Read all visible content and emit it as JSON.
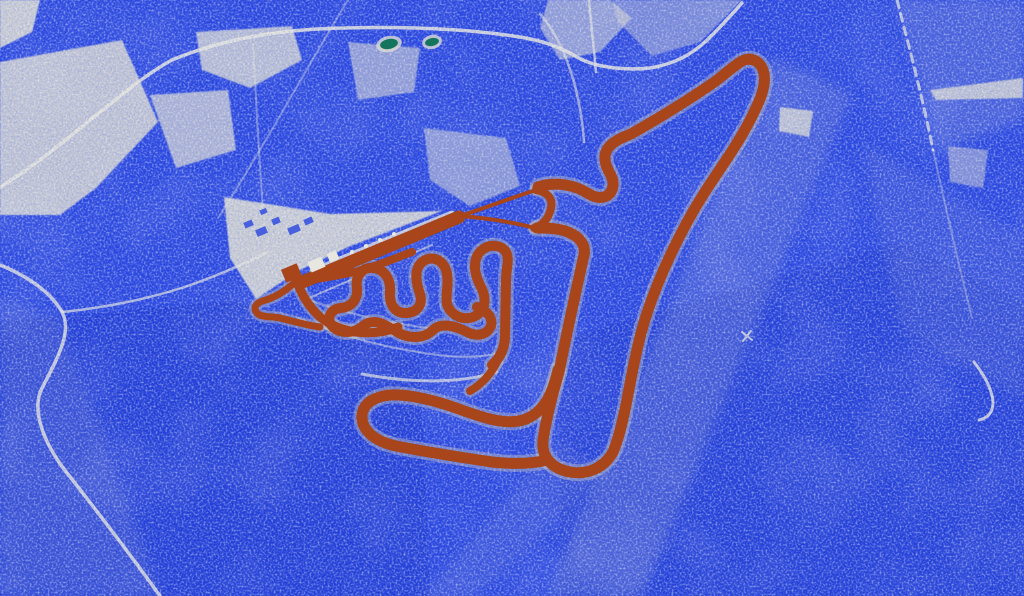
{
  "meta": {
    "description": "Stylized blue-dithered aerial satellite view of a race circuit, track highlighted in rust orange",
    "type": "aerial-map"
  },
  "colors": {
    "base_blue": "#2845df",
    "deep_blue": "#1c37d0",
    "field_white": "#d9d8d0",
    "road_white": "#e6e5dd",
    "track_rust": "#a8451a",
    "track_edge_gray": "#c9c8c0",
    "pond_teal": "#15745e",
    "pond_halo": "#dcdbd3",
    "building_white": "#e8e7df",
    "building_blue": "#2845df"
  },
  "map": {
    "darks": {
      "d1": "M 0,322 L 238,300 L 420,362 L 430,596 L 0,596 Z",
      "d2": "M 560,340 L 900,242 L 1024,302 L 1024,596 L 560,596 Z"
    },
    "bands": {
      "b1": "M 772,58 L 852,94 L 642,596 L 548,596 Z",
      "b2": "M 0,300 L 58,316 L 162,596 L 0,596 Z",
      "b3": "M 862,142 L 1024,238 L 1024,400 L 902,330 Z",
      "b4": "M 897,0 L 1024,0 L 1024,120 L 938,150 Z",
      "b5": "M 420,596 L 558,442 L 612,472 L 474,596 Z"
    },
    "fields": {
      "f1": "M 0,0 L 40,0 L 32,32 L 0,48 Z",
      "f2": "M 0,62 L 122,40 L 158,122 L 96,188 L 60,215 L 0,215 Z",
      "f3": "M 196,32 L 292,26 L 302,60 L 250,88 L 202,70 Z",
      "f4": "M 150,95 L 228,90 L 236,150 L 176,168 Z",
      "f5": "M 348,42 L 420,48 L 414,92 L 358,100 Z",
      "f6": "M 424,128 L 506,138 L 520,186 L 470,206 L 430,180 Z",
      "f7": "M 224,197 L 330,214 L 442,211 L 348,247 L 300,270 L 256,299 L 230,258 Z",
      "f8": "M 548,0 L 610,0 L 632,18 L 600,52 L 560,60 L 540,28 Z",
      "f9": "M 612,0 L 742,0 L 700,42 L 652,56 L 618,22 Z",
      "f10": "M 780,107 L 813,111 L 809,137 L 779,131 Z",
      "f11": "M 930,90 L 1023,78 L 1023,98 L 936,100 Z",
      "f12": "M 948,146 L 988,150 L 983,188 L 950,182 Z"
    },
    "roads": {
      "r1": "M 0,187 C 55,155 125,85 172,60 C 230,36 290,29 345,28 C 420,26 475,30 520,37 C 545,41 562,48 577,57 C 592,66 620,71 650,68 C 675,64 692,54 706,41 C 719,29 731,15 742,3",
      "r2": "M 0,265 C 30,277 52,294 62,312 C 72,330 60,354 42,388 C 30,412 46,448 71,478 C 96,510 130,554 160,596",
      "r3": "M 62,312 C 102,308 152,299 196,283 C 226,272 248,262 268,252",
      "r4": "M 589,0 C 591,24 594,48 596,72",
      "r5": "M 540,14 C 556,32 566,55 574,82 C 580,105 583,124 584,142",
      "r6": "M 897,0 C 910,50 924,104 933,150",
      "r7": "M 933,150 C 945,205 958,262 972,318",
      "r8": "M 348,0 C 310,62 262,150 218,218",
      "r9": "M 253,44 C 256,100 259,158 263,210",
      "r10": "M 974,362 C 985,376 992,389 993,402 C 993,412 988,418 979,420",
      "r11": "M 302,301 L 432,245",
      "r12": "M 312,271 C 360,250 410,230 452,213",
      "r13": "M 362,374 C 405,382 455,385 497,372",
      "r14": "M 298,318 C 340,336 392,350 446,356 C 472,358 492,356 506,351",
      "r15": "M 312,301 C 352,315 402,327 452,330",
      "r16": "M 742,332 L 752,340 M 751,331 L 743,341"
    },
    "track": {
      "sf_straight": "M 300,283 L 459,217",
      "tri_upper": "M 460,216 C 485,208 511,198 536,190",
      "tri_lower": "M 460,216 C 486,218 512,222 535,228",
      "tri_cap": "M 536,190 C 548,192 553,199 551,208 C 549,217 544,225 534,228",
      "main_loop": "M 538,187 C 556,181 575,185 589,194 C 601,201 612,197 613,185 C 614,175 604,169 605,156 C 606,145 618,139 631,134 C 659,118 687,101 713,83 C 723,76 732,67 742,61 C 752,56 762,62 764,74 C 766,85 761,98 755,110 C 741,141 718,171 703,195 C 681,230 660,274 647,313 C 638,340 632,373 627,400 C 623,420 619,438 613,452 C 604,468 588,475 570,472 C 553,469 541,458 543,440 C 546,420 552,396 559,372 C 566,337 575,295 584,255 C 586,245 580,237 568,232 C 558,228 546,228 537,228",
      "bl_hairpin": "M 558,370 C 552,396 543,412 526,419 C 508,426 486,419 456,408 C 436,401 416,396 399,395 C 381,394 364,400 362,415 C 361,429 373,441 396,446 C 422,451 458,457 492,462 C 510,464 528,464 543,461",
      "p_exit": "M 497,362 C 491,374 482,384 470,391",
      "infield": "M 492,365 C 500,358 505,348 505,335 L 506,280 C 506,268 510,260 506,252 C 500,243 486,244 479,253 C 473,261 474,273 480,285 C 486,296 487,308 477,315 C 466,322 451,317 447,304 C 445,293 450,282 446,270 C 442,258 429,255 421,263 C 414,270 416,283 420,294 C 423,305 417,313 405,313 C 394,313 389,303 390,292 C 391,280 385,269 373,268 C 362,267 355,276 357,288 C 358,299 352,307 341,308 C 331,309 326,317 332,326 C 339,334 354,334 363,326 C 374,317 386,325 397,332 C 409,339 424,339 433,330 C 441,322 456,326 467,332 C 477,337 487,335 491,326 C 493,318 487,310 477,307",
      "pit_elbow": "M 296,278 C 300,292 308,306 320,317 C 330,325 342,330 356,332 C 372,334 386,332 398,327",
      "pit_hook": "M 293,284 C 284,292 275,297 266,300 C 257,302 252,307 257,313 C 261,318 272,316 280,318 C 292,321 306,325 320,327",
      "lower_link": "M 295,282 C 315,280 335,276 355,272 C 375,267 395,258 412,252"
    },
    "buildings": {
      "white_1": {
        "x": "309",
        "y": "259",
        "w": "15",
        "h": "11"
      },
      "white_2": {
        "x": "328",
        "y": "252",
        "w": "10",
        "h": "9"
      },
      "rust_blob": {
        "x": "283",
        "y": "266",
        "w": "17",
        "h": "14"
      },
      "blue_1": {
        "x": "244",
        "y": "221",
        "w": "9",
        "h": "6"
      },
      "blue_2": {
        "x": "256",
        "y": "228",
        "w": "11",
        "h": "7"
      },
      "blue_3": {
        "x": "272",
        "y": "218",
        "w": "8",
        "h": "6"
      },
      "blue_4": {
        "x": "288",
        "y": "226",
        "w": "12",
        "h": "7"
      },
      "blue_5": {
        "x": "304",
        "y": "218",
        "w": "9",
        "h": "6"
      },
      "blue_6": {
        "x": "260",
        "y": "209",
        "w": "7",
        "h": "5"
      }
    },
    "grid_dots": {
      "g1": {
        "cx": "352",
        "cy": "252"
      },
      "g2": {
        "cx": "366",
        "cy": "246"
      },
      "g3": {
        "cx": "380",
        "cy": "240"
      },
      "g4": {
        "cx": "394",
        "cy": "234"
      }
    },
    "ponds": {
      "p1": {
        "cx": "389",
        "cy": "44",
        "rx": "9",
        "ry": "5"
      },
      "p2": {
        "cx": "432",
        "cy": "42",
        "rx": "7",
        "ry": "4"
      }
    }
  }
}
